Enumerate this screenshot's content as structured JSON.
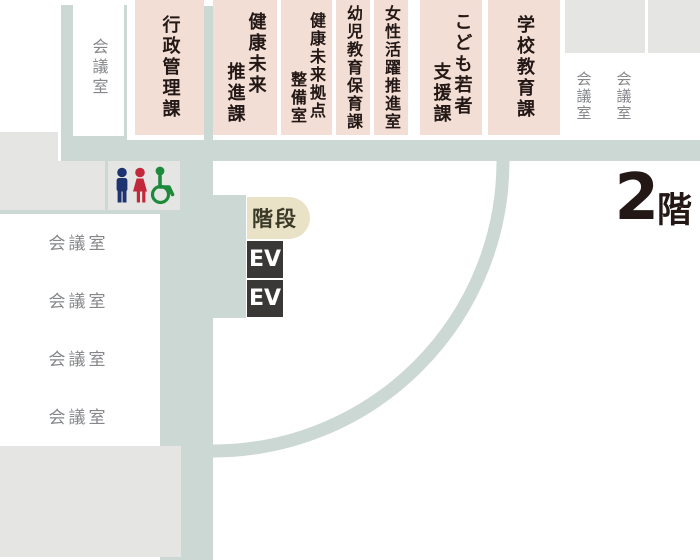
{
  "floor_label": {
    "number": "2",
    "suffix": "階"
  },
  "departments": [
    {
      "name": "行政管理課",
      "lines": [
        "行政管理課"
      ]
    },
    {
      "name": "健康未来推進課",
      "lines": [
        "健康未来",
        "推進課"
      ]
    },
    {
      "name": "健康未来拠点整備室",
      "lines": [
        "健康未来拠点",
        "整備室"
      ]
    },
    {
      "name": "幼児教育保育課",
      "lines": [
        "幼児教育保育課"
      ]
    },
    {
      "name": "女性活躍推進室",
      "lines": [
        "女性活躍推進室"
      ]
    },
    {
      "name": "こども若者支援課",
      "lines": [
        "こども若者",
        "支援課"
      ]
    },
    {
      "name": "学校教育課",
      "lines": [
        "学校教育課"
      ]
    }
  ],
  "rooms": {
    "meeting_room": "会議室"
  },
  "facilities": {
    "stairs": "階段",
    "elevator": "EV"
  },
  "icons": {
    "restroom": [
      "mens-room-icon",
      "womens-room-icon",
      "wheelchair-accessible-icon"
    ]
  },
  "colors": {
    "corridor": "#ccd8d3",
    "department_fill": "#f2ded5",
    "area_gray": "#e5e6e4",
    "stairs_fill": "#e9e2c7",
    "elevator_fill": "#3a3837",
    "text_dark": "#231815",
    "text_gray": "#85878a",
    "icon_men": "#1e3470",
    "icon_women": "#c2273c",
    "icon_wheelchair": "#1d8a3b"
  }
}
